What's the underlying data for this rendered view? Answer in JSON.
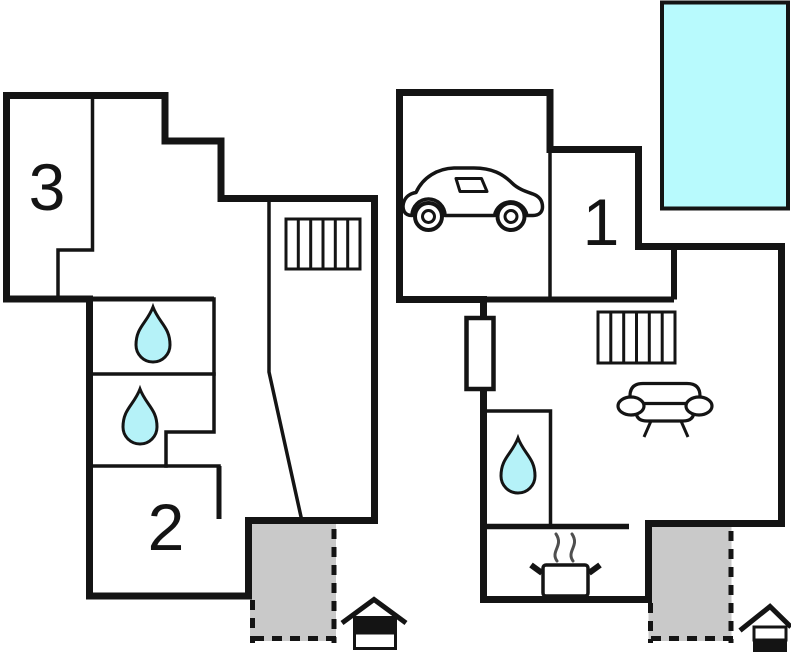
{
  "document": {
    "kind": "holiday-home floor plan, two floors side by side",
    "background": "#ffffff"
  },
  "colors": {
    "wall": "#141414",
    "water_drop": "#b5f2f8",
    "pool": "#b8fafd",
    "terrace": "#c9c9c9",
    "steam": "#4f4f4f",
    "white": "#ffffff"
  },
  "rooms": {
    "room1": "1",
    "room2": "2",
    "room3": "3"
  },
  "plans": [
    {
      "name": "upper-floor",
      "room_labels": [
        "3",
        "2"
      ],
      "icons": [
        "stairs-icon",
        "water-drop-icon",
        "water-drop-icon",
        "house-level-marker-icon"
      ],
      "areas": [
        "terrace"
      ]
    },
    {
      "name": "ground-floor",
      "room_labels": [
        "1"
      ],
      "icons": [
        "car-icon",
        "stairs-icon",
        "sofa-icon",
        "water-drop-icon",
        "stove-icon",
        "door-marker",
        "house-level-marker-icon"
      ],
      "areas": [
        "pool",
        "terrace"
      ]
    }
  ]
}
